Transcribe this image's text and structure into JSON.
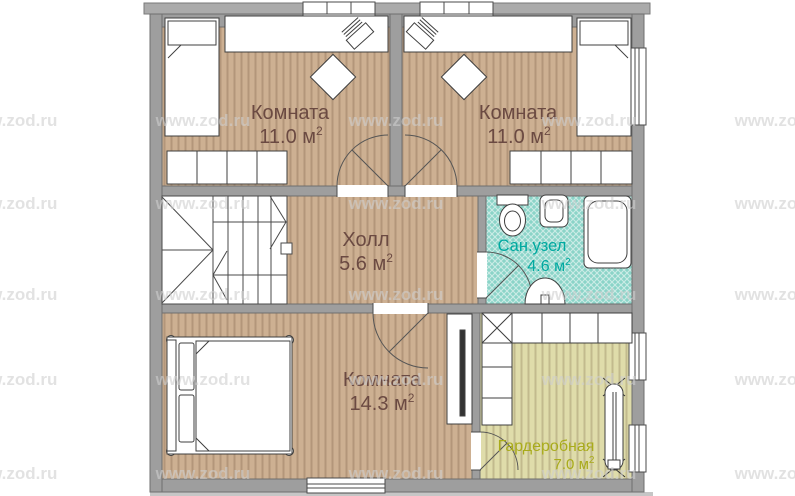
{
  "watermark": {
    "text": "www.zod.ru"
  },
  "colors": {
    "wall": "#9e9e9e",
    "wall_outline": "#6f6f6f",
    "floor_wood": "#cdb092",
    "floor_bath": "#8bd4c8",
    "floor_wardrobe": "#dfdcaa",
    "room_label": "#6b4a42",
    "bath_label": "#00a9a0",
    "wardrobe_label": "#a9ab1b"
  },
  "rooms": {
    "bedroom_top_left": {
      "name": "Комната",
      "area_value": "11.0 м",
      "area_sup": "2"
    },
    "bedroom_top_right": {
      "name": "Комната",
      "area_value": "11.0 м",
      "area_sup": "2"
    },
    "hall": {
      "name": "Холл",
      "area_value": "5.6 м",
      "area_sup": "2"
    },
    "bathroom": {
      "name": "Сан.узел",
      "area_value": "4.6 м",
      "area_sup": "2"
    },
    "bedroom_bottom": {
      "name": "Комната",
      "area_value": "14.3 м",
      "area_sup": "2"
    },
    "wardrobe": {
      "name": "Гардеробная",
      "area_value": "7.0 м",
      "area_sup": "2"
    }
  }
}
